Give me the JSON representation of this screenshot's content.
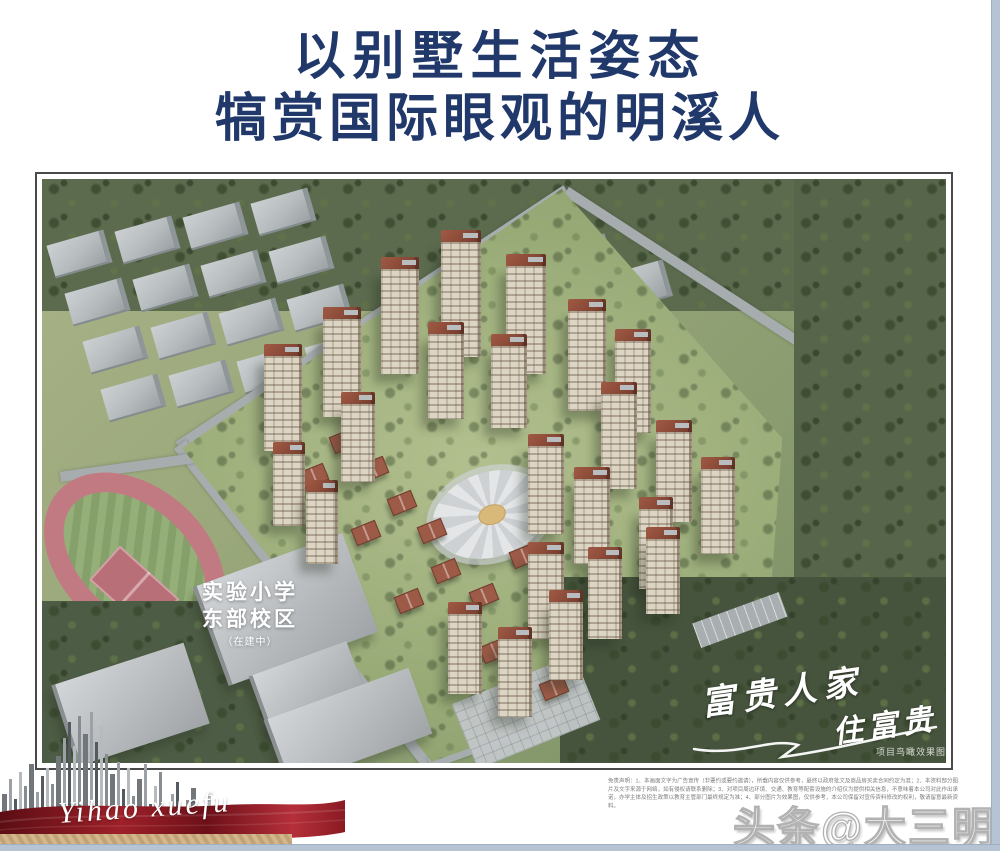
{
  "page": {
    "width": 1000,
    "height": 851,
    "background": "#ffffff",
    "edge_strip_color": "#b6c3d2"
  },
  "header": {
    "title_line1": "以别墅生活姿态",
    "title_line2": "犒赏国际眼观的明溪人",
    "color": "#21386b"
  },
  "render": {
    "school_label": {
      "line1": "实验小学",
      "line2": "东部校区",
      "line3": "（在建中）"
    },
    "calligraphy": {
      "part1": "富贵人家",
      "part2": "住富贵"
    },
    "caption": "项目鸟瞰效果图"
  },
  "disclaimer": {
    "text": "免责声明：1、本画面文字为广告宣传（非要约或要约邀请），所载内容仅供参考，最终以政府批文及商品房买卖合同约定为准；2、本资料部分图片及文字来源于网络，如有侵权请联系删除；3、对项目周边环境、交通、教育等配套设施的介绍仅为提供相关信息，不意味着本公司对此作出承诺，办学主体及招生政策以教育主管部门最终规定为准；4、部分图片为效果图，仅供参考，本公司保留对宣传资料修改的权利，敬请留意最新资料。"
  },
  "logo": {
    "script_text": "Yihao xuefu",
    "ribbon_color": "#9e2029",
    "gold_color": "#c9ab7e",
    "bar_heights": [
      40,
      55,
      35,
      62,
      48,
      70,
      42,
      58,
      66,
      50,
      78,
      96,
      112,
      88,
      118,
      100,
      122,
      92,
      108,
      80,
      60,
      72,
      45,
      66,
      38,
      55,
      70,
      30,
      48,
      62,
      24,
      40,
      52,
      20,
      34,
      46,
      16,
      28,
      38,
      12
    ]
  },
  "watermark": {
    "text": "头条@大三明"
  },
  "scene": {
    "towers": [
      [
        339,
        78,
        38,
        105
      ],
      [
        399,
        51,
        40,
        115
      ],
      [
        464,
        75,
        40,
        108
      ],
      [
        526,
        120,
        38,
        100
      ],
      [
        573,
        150,
        36,
        92
      ],
      [
        281,
        128,
        38,
        98
      ],
      [
        222,
        165,
        38,
        95
      ],
      [
        386,
        143,
        36,
        85
      ],
      [
        449,
        155,
        36,
        82
      ],
      [
        559,
        203,
        36,
        95
      ],
      [
        614,
        241,
        36,
        90
      ],
      [
        659,
        278,
        34,
        85
      ],
      [
        486,
        255,
        36,
        88
      ],
      [
        532,
        288,
        36,
        85
      ],
      [
        597,
        318,
        34,
        80
      ],
      [
        486,
        363,
        36,
        85
      ],
      [
        546,
        368,
        34,
        80
      ],
      [
        604,
        348,
        34,
        75
      ],
      [
        406,
        423,
        34,
        80
      ],
      [
        456,
        448,
        34,
        78
      ],
      [
        507,
        411,
        34,
        78
      ],
      [
        231,
        263,
        32,
        72
      ],
      [
        264,
        301,
        32,
        72
      ],
      [
        299,
        213,
        34,
        78
      ]
    ],
    "villas": [
      [
        289,
        253
      ],
      [
        319,
        281
      ],
      [
        259,
        288
      ],
      [
        347,
        315
      ],
      [
        377,
        343
      ],
      [
        311,
        345
      ],
      [
        391,
        383
      ],
      [
        429,
        408
      ],
      [
        354,
        413
      ],
      [
        469,
        368
      ],
      [
        439,
        463
      ],
      [
        499,
        500
      ]
    ],
    "roads": [
      [
        331,
        140,
        465,
        13,
        -33.5
      ],
      [
        692,
        121,
        400,
        10,
        33
      ],
      [
        264,
        427,
        410,
        15,
        52
      ],
      [
        554,
        524,
        355,
        12,
        -20
      ],
      [
        110,
        285,
        185,
        10,
        -8
      ]
    ],
    "factories": [
      [
        508,
        62
      ],
      [
        566,
        88
      ]
    ],
    "warehouse_grid": {
      "rows": 4,
      "cols": 4,
      "w": 54,
      "h": 32
    }
  }
}
